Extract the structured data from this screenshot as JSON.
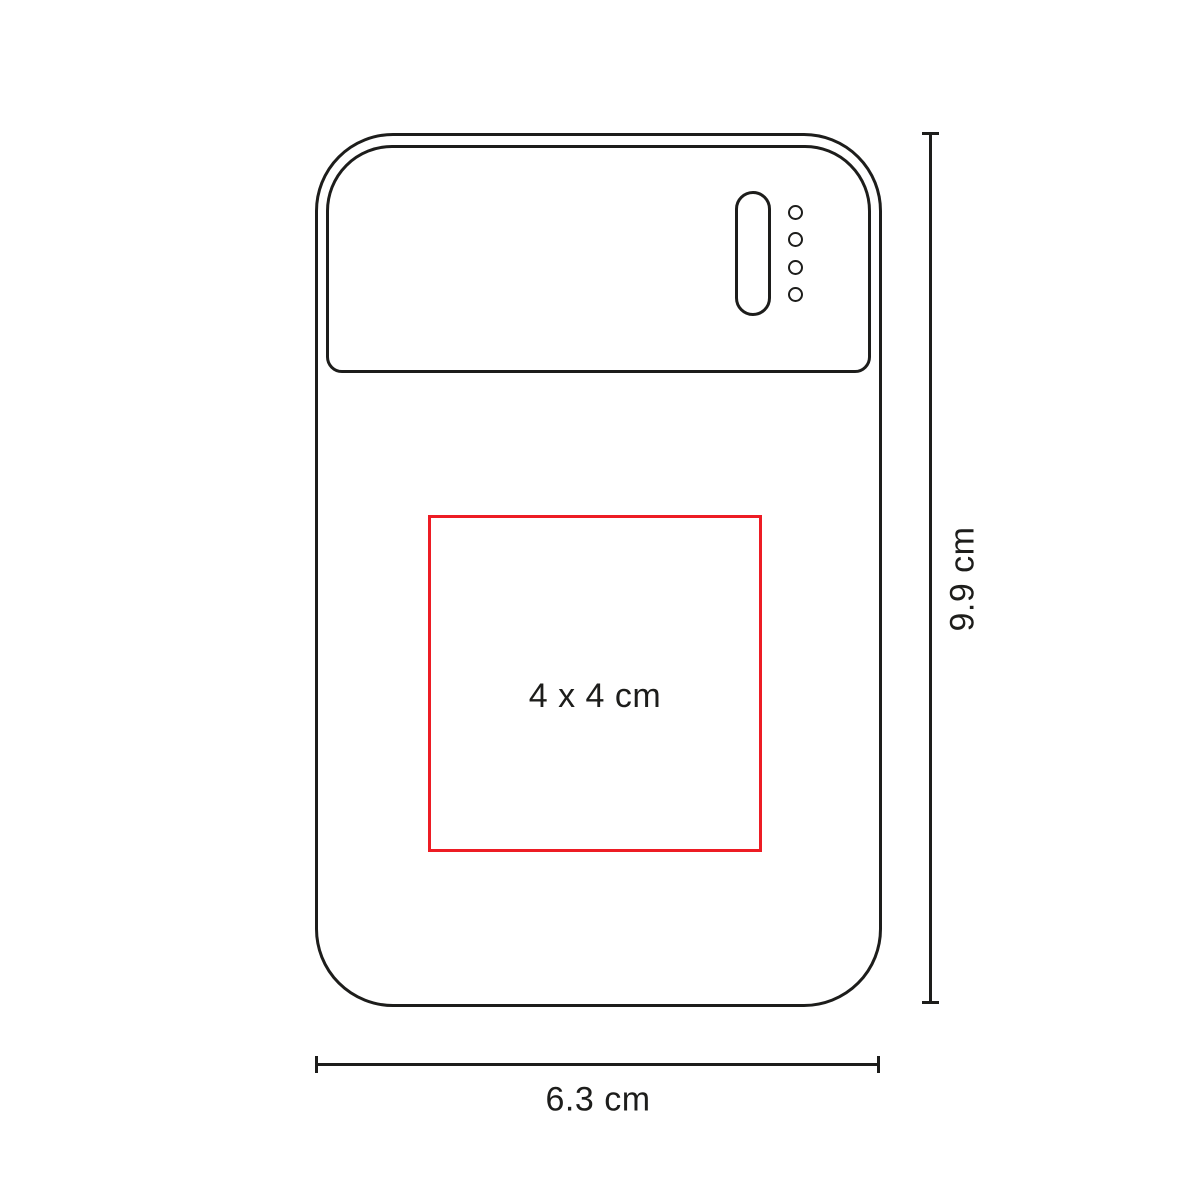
{
  "product_diagram": {
    "type": "power-bank-print-area-spec",
    "print_area": {
      "label": "4 x 4 cm"
    },
    "dimensions": {
      "height": {
        "label": "9.9 cm"
      },
      "width": {
        "label": "6.3 cm"
      }
    },
    "indicators": {
      "led_count": 4
    }
  },
  "colors": {
    "outline": "#1d1d1b",
    "print_area_accent": "#ed1c24",
    "text": "#1d1d1b",
    "background": "#ffffff"
  }
}
